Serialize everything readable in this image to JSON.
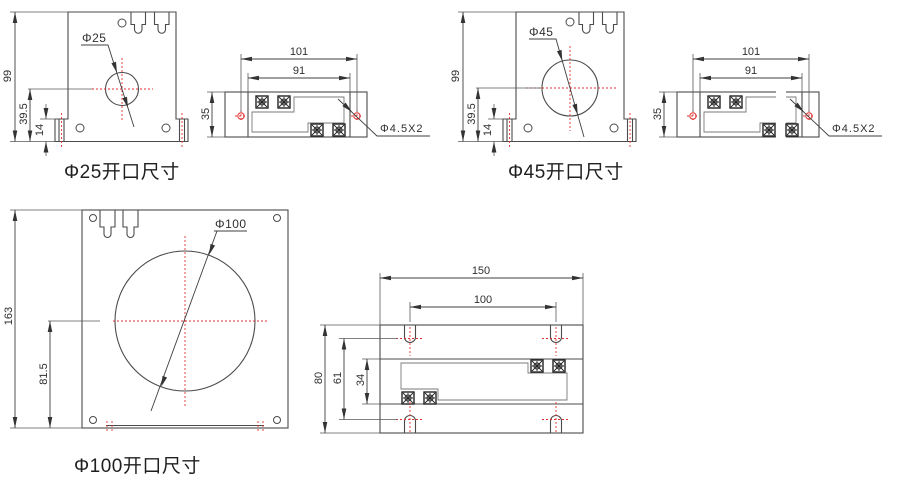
{
  "colors": {
    "line": "#4b4b4b",
    "thin_line": "#7a7a7a",
    "centerline_red": "#e03131",
    "text": "#2f2f2f"
  },
  "figures": {
    "front25": {
      "title": "Φ25开口尺寸",
      "hole_label": "Φ25",
      "dim_height": "99",
      "dim_center_height": "39.5",
      "dim_base": "14"
    },
    "top25": {
      "dim_width": "101",
      "dim_hole_spacing": "91",
      "dim_depth": "35",
      "screw_label": "Φ4.5X2"
    },
    "front45": {
      "title": "Φ45开口尺寸",
      "hole_label": "Φ45",
      "dim_height": "99",
      "dim_center_height": "39.5",
      "dim_base": "14"
    },
    "top45": {
      "dim_width": "101",
      "dim_hole_spacing": "91",
      "dim_depth": "35",
      "screw_label": "Φ4.5X2"
    },
    "front100": {
      "title": "Φ100开口尺寸",
      "hole_label": "Φ100",
      "dim_height": "163",
      "dim_center_height": "81.5"
    },
    "top100": {
      "dim_width": "150",
      "dim_slot_spacing": "100",
      "dim_depth": "80",
      "dim_inner": "61",
      "dim_band": "34"
    }
  }
}
